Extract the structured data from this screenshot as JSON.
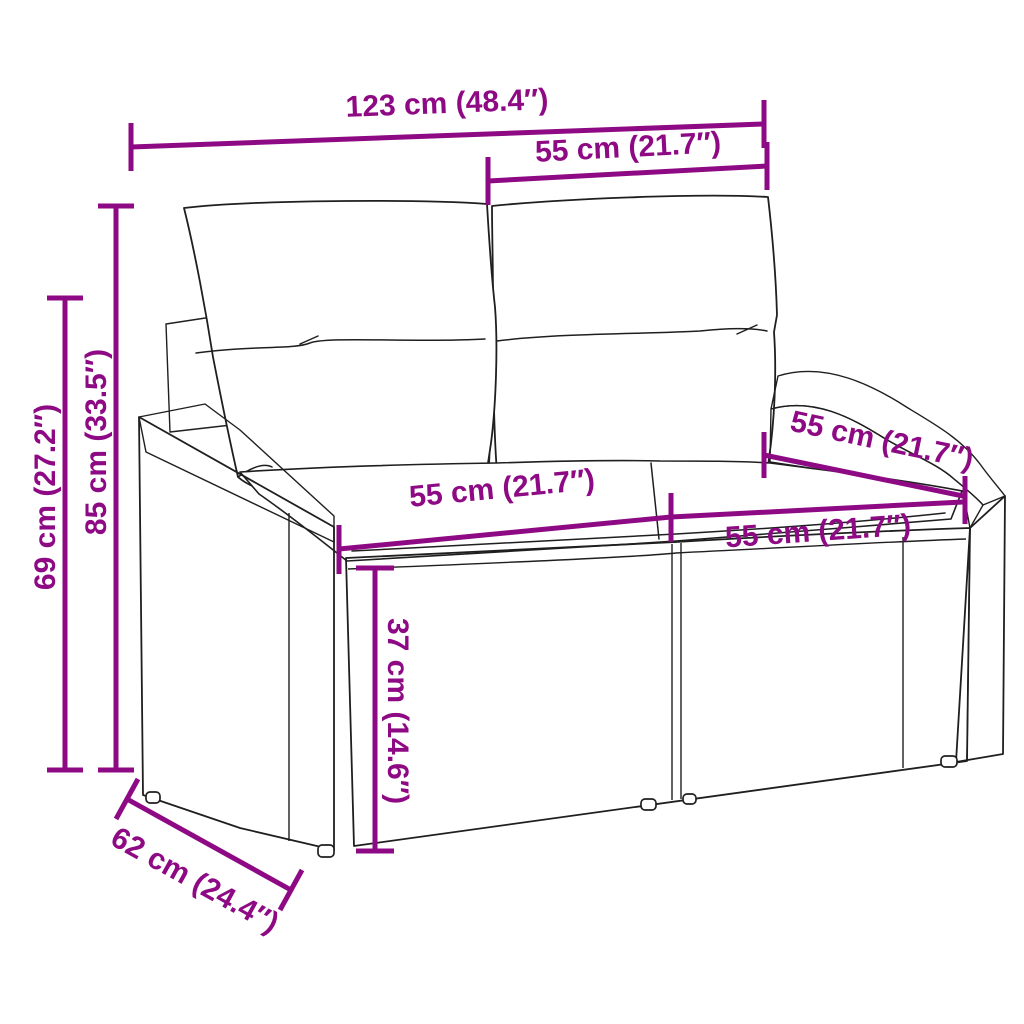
{
  "figure": {
    "background": "#ffffff",
    "accent_color": "#8E0A84",
    "outline_color": "#1f1f1f"
  },
  "dims": {
    "total_width": {
      "label": "123 cm (48.4″)"
    },
    "backrest_width": {
      "label": "55 cm (21.7″)"
    },
    "total_height": {
      "label": "85 cm (33.5″)"
    },
    "arm_height": {
      "label": "69 cm (27.2″)"
    },
    "seat_width_left": {
      "label": "55 cm (21.7″)"
    },
    "seat_width_right": {
      "label": "55 cm (21.7″)"
    },
    "seat_depth": {
      "label": "55 cm (21.7″)"
    },
    "seat_height": {
      "label": "37 cm (14.6″)"
    },
    "total_depth": {
      "label": "62 cm (24.4″)"
    }
  }
}
